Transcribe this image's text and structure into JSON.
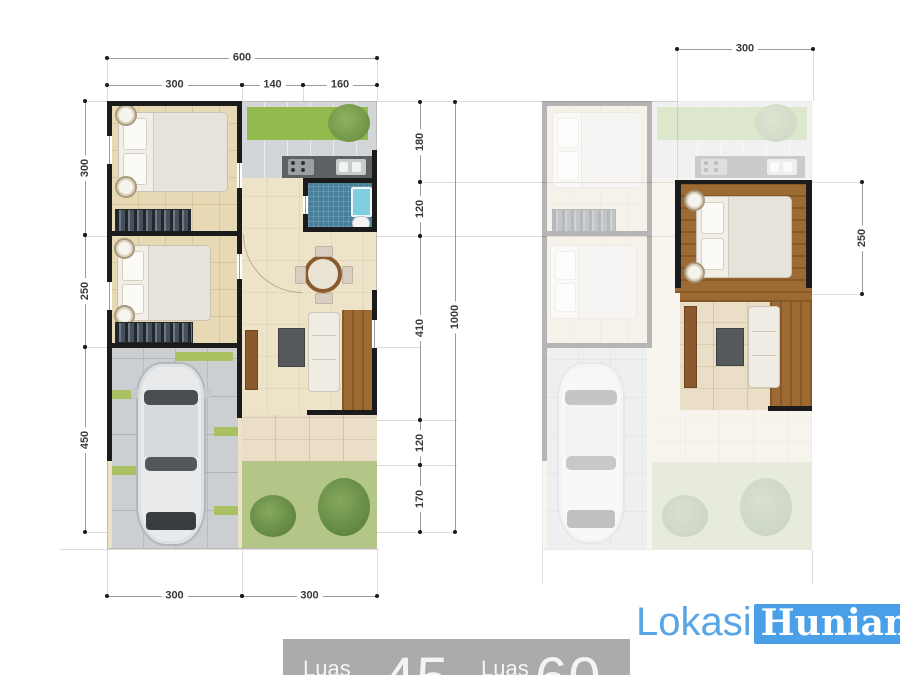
{
  "logo": {
    "text_primary": "Lokasi",
    "text_secondary": "Hunian"
  },
  "footer_bar": {
    "area_label_1": "Luas",
    "area_value_1": "45",
    "area_label_2": "Luas",
    "area_value_2": "60"
  },
  "left_plan": {
    "dim_top_total": "600",
    "dim_top_segments": [
      "300",
      "140",
      "160"
    ],
    "dim_left_segments": [
      "300",
      "250",
      "450"
    ],
    "dim_right_segments": [
      "180",
      "120",
      "410",
      "120",
      "170"
    ],
    "dim_right_total": "1000",
    "dim_bottom_segments": [
      "300",
      "300"
    ]
  },
  "right_plan": {
    "dim_top": "300",
    "dim_right": "250"
  },
  "colors": {
    "logo_blue_box": "#4aa0e8",
    "logo_blue_text": "#58a6e8",
    "footer_gray": "#ababab",
    "wall_black": "#1b1b1b",
    "floor_cream": "#ece3c8",
    "bedroom_tile": "#e7d9b4",
    "wood_brown": "#9d6a33",
    "garden_green": "#93bb4d",
    "lawn_green": "#b3c687",
    "bath_blue": "#47809b",
    "carport_gray": "#cbcfd2"
  }
}
